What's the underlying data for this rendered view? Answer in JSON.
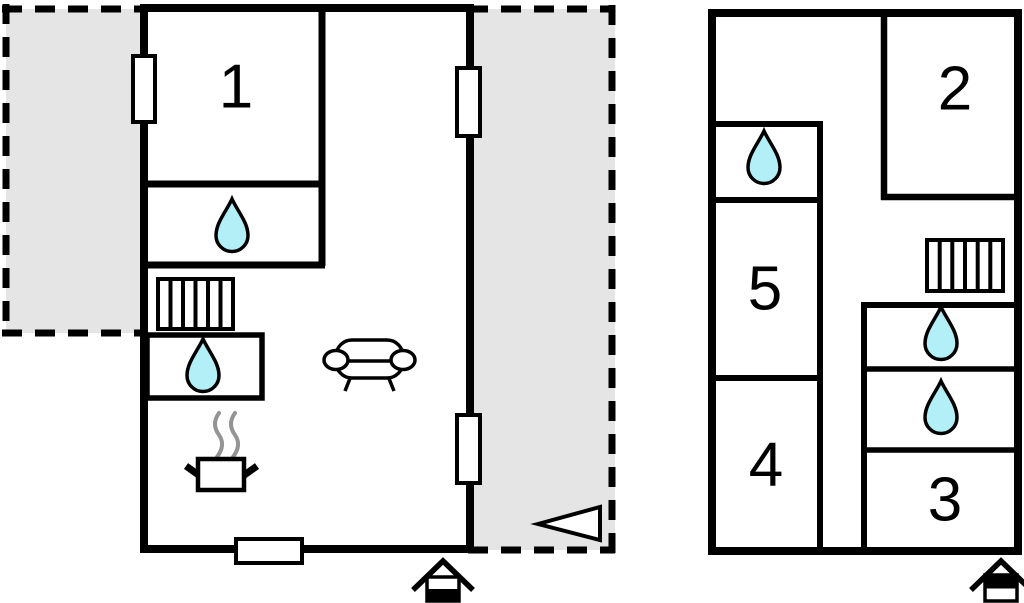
{
  "colors": {
    "wall": "#000000",
    "water_fill": "#b2eff7",
    "terrace_fill": "#e5e5e5",
    "steam": "#949494",
    "background": "#ffffff"
  },
  "floors": [
    {
      "name": "left-floor",
      "storey_indicator_filled": "bottom",
      "rooms": [
        {
          "label": "1"
        }
      ],
      "icons": [
        "water-drop",
        "water-drop",
        "stairs",
        "stove",
        "sofa",
        "window",
        "window",
        "window",
        "door",
        "entrance-arrow",
        "storey-indicator"
      ],
      "terraces": [
        "left-terrace",
        "right-terrace"
      ]
    },
    {
      "name": "right-floor",
      "storey_indicator_filled": "top",
      "rooms": [
        {
          "label": "2"
        },
        {
          "label": "5"
        },
        {
          "label": "4"
        },
        {
          "label": "3"
        }
      ],
      "icons": [
        "water-drop",
        "water-drop",
        "water-drop",
        "stairs",
        "storey-indicator"
      ],
      "terraces": []
    }
  ],
  "entrance_arrow": {
    "direction": "left"
  }
}
